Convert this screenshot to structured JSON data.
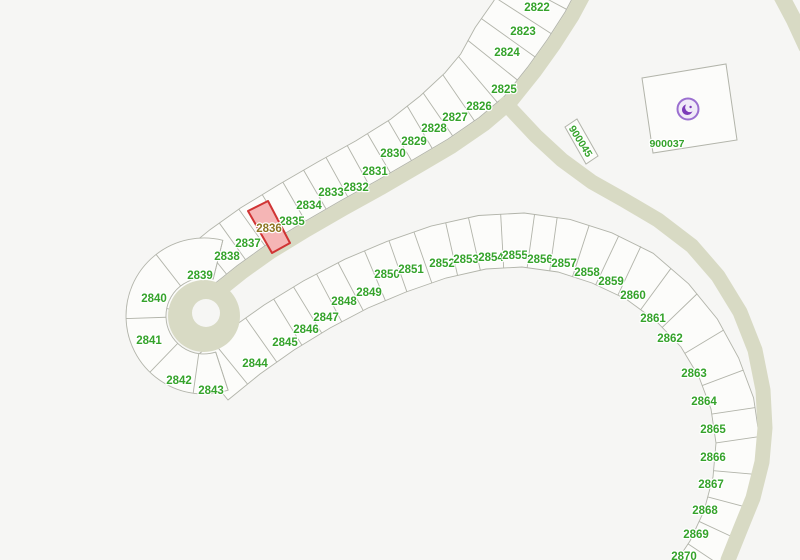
{
  "map": {
    "title": "parcel-plat-map",
    "selected_lot": "2836",
    "colors": {
      "background": "#f6f6f4",
      "road": "#d8dac4",
      "lot_fill": "#fcfcfa",
      "lot_border": "#b2b4aa",
      "label": "#35a32b",
      "selected_label": "#8d7522",
      "highlight_fill": "#f5b5b5",
      "highlight_border": "#d03434",
      "poi_ring": "#9b6fd0",
      "poi_glyph": "#7b3ab8",
      "poi_bg": "#f0eaf8"
    },
    "poi": {
      "icon": "mosque-icon",
      "x": 688,
      "y": 109,
      "parcel": "900037"
    },
    "lots": [
      {
        "id": "2822",
        "x": 537,
        "y": 7
      },
      {
        "id": "2823",
        "x": 523,
        "y": 31
      },
      {
        "id": "2824",
        "x": 507,
        "y": 52
      },
      {
        "id": "2825",
        "x": 504,
        "y": 89
      },
      {
        "id": "2826",
        "x": 479,
        "y": 106
      },
      {
        "id": "2827",
        "x": 455,
        "y": 117
      },
      {
        "id": "2828",
        "x": 434,
        "y": 128
      },
      {
        "id": "2829",
        "x": 414,
        "y": 141
      },
      {
        "id": "2830",
        "x": 393,
        "y": 153
      },
      {
        "id": "2831",
        "x": 375,
        "y": 171
      },
      {
        "id": "2832",
        "x": 356,
        "y": 187
      },
      {
        "id": "2833",
        "x": 331,
        "y": 192
      },
      {
        "id": "2834",
        "x": 309,
        "y": 205
      },
      {
        "id": "2835",
        "x": 292,
        "y": 221
      },
      {
        "id": "2836",
        "x": 269,
        "y": 228,
        "selected": true
      },
      {
        "id": "2837",
        "x": 248,
        "y": 243
      },
      {
        "id": "2838",
        "x": 227,
        "y": 256
      },
      {
        "id": "2839",
        "x": 200,
        "y": 275
      },
      {
        "id": "2840",
        "x": 154,
        "y": 298
      },
      {
        "id": "2841",
        "x": 149,
        "y": 340
      },
      {
        "id": "2842",
        "x": 179,
        "y": 380
      },
      {
        "id": "2843",
        "x": 211,
        "y": 390
      },
      {
        "id": "2844",
        "x": 255,
        "y": 363
      },
      {
        "id": "2845",
        "x": 285,
        "y": 342
      },
      {
        "id": "2846",
        "x": 306,
        "y": 329
      },
      {
        "id": "2847",
        "x": 326,
        "y": 317
      },
      {
        "id": "2848",
        "x": 344,
        "y": 301
      },
      {
        "id": "2849",
        "x": 369,
        "y": 292
      },
      {
        "id": "2850",
        "x": 387,
        "y": 274
      },
      {
        "id": "2851",
        "x": 411,
        "y": 269
      },
      {
        "id": "2852",
        "x": 442,
        "y": 263
      },
      {
        "id": "2853",
        "x": 466,
        "y": 259
      },
      {
        "id": "2854",
        "x": 491,
        "y": 257
      },
      {
        "id": "2855",
        "x": 515,
        "y": 255
      },
      {
        "id": "2856",
        "x": 540,
        "y": 259
      },
      {
        "id": "2857",
        "x": 564,
        "y": 263
      },
      {
        "id": "2858",
        "x": 587,
        "y": 272
      },
      {
        "id": "2859",
        "x": 611,
        "y": 281
      },
      {
        "id": "2860",
        "x": 633,
        "y": 295
      },
      {
        "id": "2861",
        "x": 653,
        "y": 318
      },
      {
        "id": "2862",
        "x": 670,
        "y": 338
      },
      {
        "id": "2863",
        "x": 694,
        "y": 373
      },
      {
        "id": "2864",
        "x": 704,
        "y": 401
      },
      {
        "id": "2865",
        "x": 713,
        "y": 429
      },
      {
        "id": "2866",
        "x": 713,
        "y": 457
      },
      {
        "id": "2867",
        "x": 711,
        "y": 484
      },
      {
        "id": "2868",
        "x": 705,
        "y": 510
      },
      {
        "id": "2869",
        "x": 696,
        "y": 534
      },
      {
        "id": "2870",
        "x": 684,
        "y": 556
      },
      {
        "id": "900045",
        "x": 581,
        "y": 141,
        "rotation": 58
      },
      {
        "id": "900037",
        "x": 667,
        "y": 143
      }
    ]
  }
}
